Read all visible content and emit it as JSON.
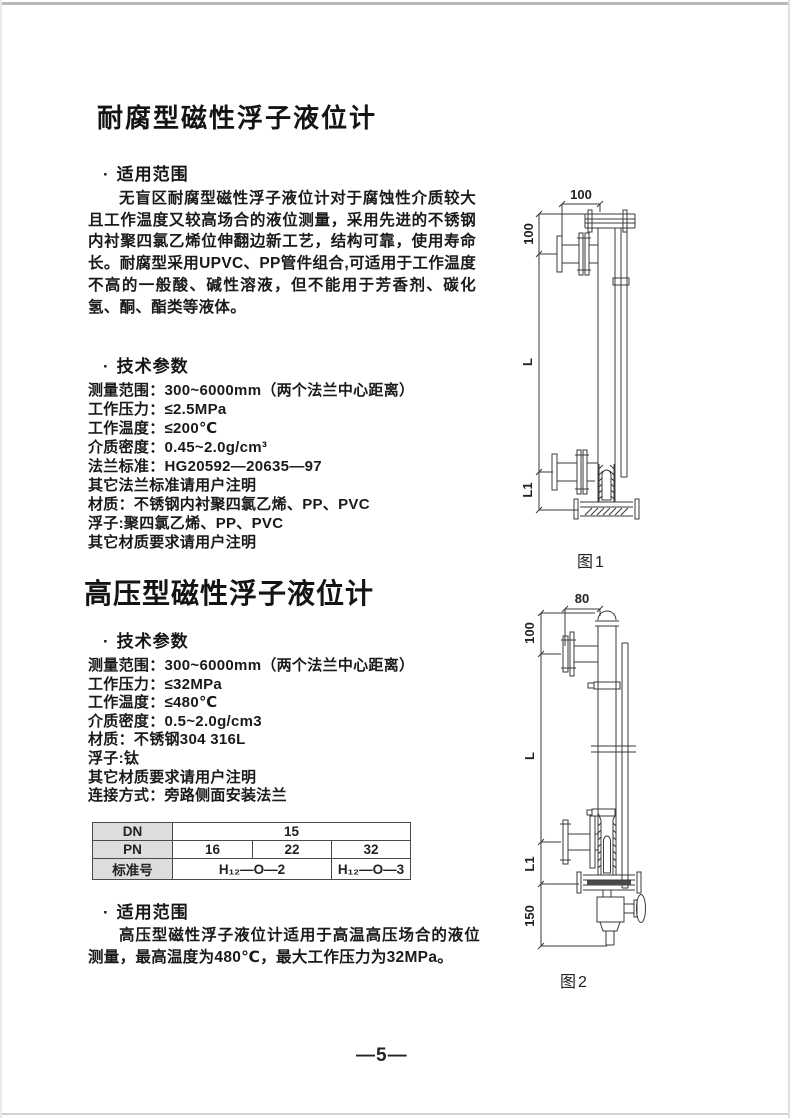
{
  "page": {
    "number": "—5—"
  },
  "bullet": "·",
  "section1": {
    "title": "耐腐型磁性浮子液位计",
    "scope_heading": "适用范围",
    "scope_text": "无盲区耐腐型磁性浮子液位计对于腐蚀性介质较大且工作温度又较高场合的液位测量，采用先进的不锈钢内衬聚四氯乙烯位伸翻边新工艺，结构可靠，使用寿命长。耐腐型采用UPVC、PP管件组合,可适用于工作温度不高的一般酸、碱性溶液，但不能用于芳香剂、碳化氢、酮、酯类等液体。",
    "params_heading": "技术参数",
    "params": [
      "测量范围：300~6000mm（两个法兰中心距离）",
      "工作压力：≤2.5MPa",
      "工作温度：≤200℃",
      "介质密度：0.45~2.0g/cm³",
      "法兰标准：HG20592—20635—97",
      "其它法兰标准请用户注明",
      "材质：不锈钢内衬聚四氯乙烯、PP、PVC",
      "浮子:聚四氯乙烯、PP、PVC",
      "其它材质要求请用户注明"
    ]
  },
  "figure1": {
    "label": "图1",
    "dim_top_width": "100",
    "dim_top_height": "100",
    "dim_length": "L",
    "dim_l1": "L1"
  },
  "section2": {
    "title": "高压型磁性浮子液位计",
    "params_heading": "技术参数",
    "params": [
      "测量范围：300~6000mm（两个法兰中心距离）",
      "工作压力：≤32MPa",
      "工作温度：≤480℃",
      "介质密度：0.5~2.0g/cm3",
      "材质：不锈钢304  316L",
      "浮子:钛",
      "其它材质要求请用户注明",
      "连接方式：旁路侧面安装法兰"
    ],
    "scope_heading": "适用范围",
    "scope_text": "高压型磁性浮子液位计适用于高温高压场合的液位测量，最高温度为480℃，最大工作压力为32MPa。"
  },
  "flange_table": {
    "row_labels": [
      "DN",
      "PN",
      "标准号"
    ],
    "dn_value": "15",
    "pn_values": [
      "16",
      "22",
      "32"
    ],
    "standard_values": [
      "H₁₂—O—2",
      "H₁₂—O—3"
    ]
  },
  "figure2": {
    "label": "图2",
    "dim_top_width": "80",
    "dim_top_height": "100",
    "dim_length": "L",
    "dim_l1": "L1",
    "dim_bottom": "150"
  }
}
